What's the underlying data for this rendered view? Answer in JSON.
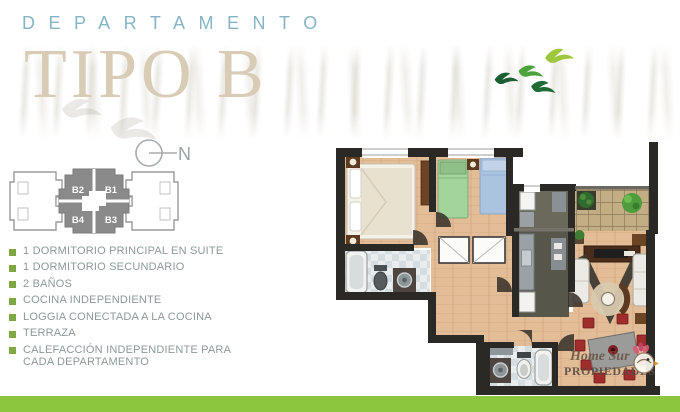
{
  "header": {
    "title_top": "DEPARTAMENTO",
    "title_main": "TIPO B"
  },
  "compass": {
    "label": "N"
  },
  "key_plan": {
    "units": [
      {
        "id": "B2"
      },
      {
        "id": "B1"
      },
      {
        "id": "B4"
      },
      {
        "id": "B3"
      }
    ]
  },
  "features": {
    "items": [
      {
        "text": "1 DORMITORIO PRINCIPAL EN SUITE"
      },
      {
        "text": "1  DORMITORIO SECUNDARIO"
      },
      {
        "text": "2 BAÑOS"
      },
      {
        "text": "COCINA INDEPENDIENTE"
      },
      {
        "text": "LOGGIA CONECTADA A LA COCINA"
      },
      {
        "text": "TERRAZA"
      },
      {
        "text": "CALEFACCIÓN  INDEPENDIENTE PARA CADA DEPARTAMENTO"
      }
    ]
  },
  "logo": {
    "line1": "Home Sur",
    "line2": "PROPIEDADES"
  },
  "colors": {
    "accent_blue": "#85b4c5",
    "title_beige": "#d9ccb6",
    "bullet_green": "#7fa743",
    "bar_green": "#8cc63e",
    "text_gray": "#8d9898",
    "wall_dark": "#2b2926",
    "wood_floor": "#e3bd97",
    "kitchen_floor": "#57564a",
    "terrace_floor": "#c3ad85",
    "bed_green": "#a3d49c",
    "bed_blue": "#aac3df",
    "chair_red": "#a02c2c"
  }
}
